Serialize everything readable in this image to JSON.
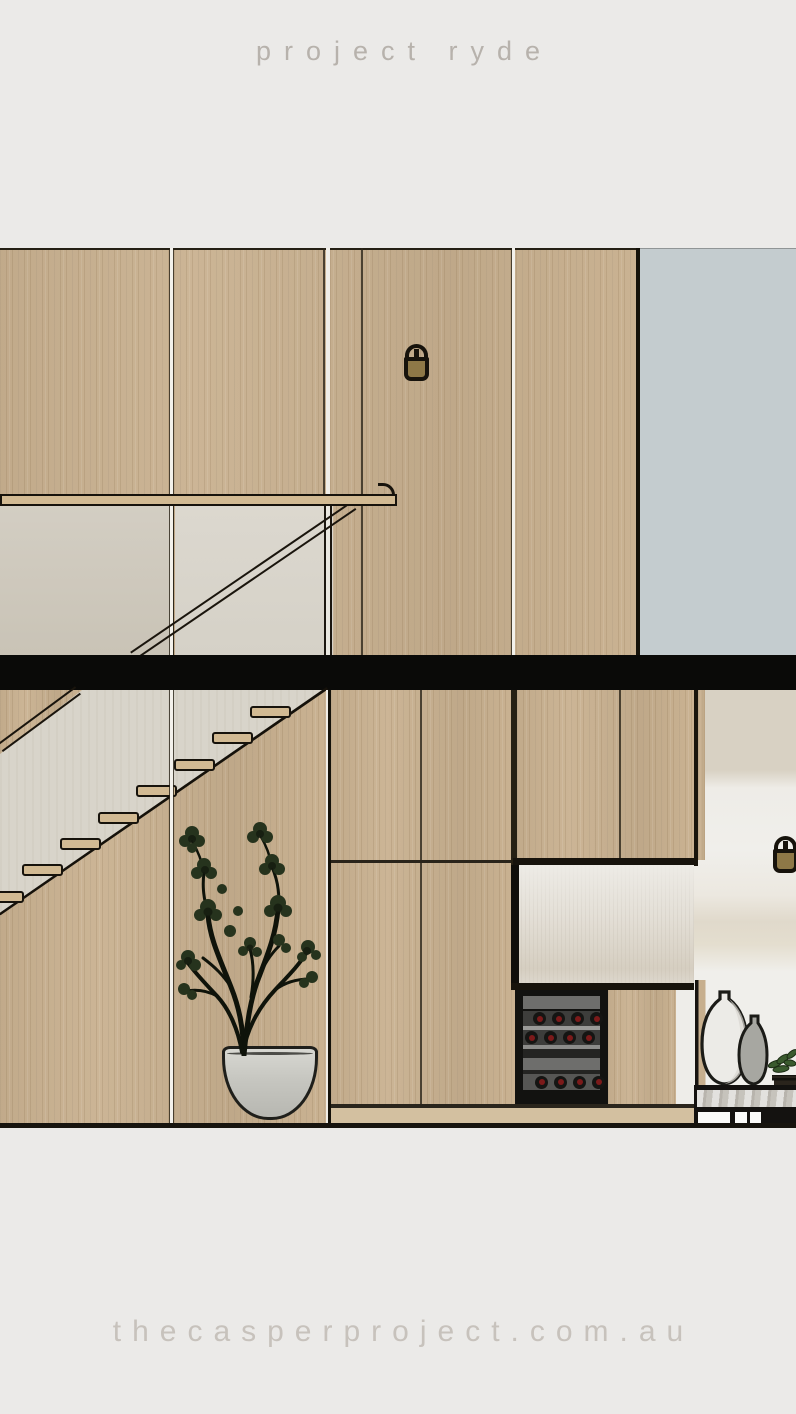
{
  "header": {
    "title": "project ryde"
  },
  "footer": {
    "website": "thecasperproject.com.au"
  },
  "palette": {
    "page-bg": "#ebeae8",
    "header-text": "#b7b2ac",
    "footer-text": "#c7c2bc",
    "timber": "#c9b190",
    "timber-light": "#d2ba93",
    "outline": "#17130c",
    "slab": "#0a0a08",
    "blue-wall": "#c4cccf",
    "plaster": "#d8d4ca",
    "white-wall": "#f0efeb",
    "marble": "#c6c3bc",
    "fridge-frame": "#121210",
    "bottle-red": "#7c1a1a",
    "pot": "#c9c9c3",
    "floor-strip": "#d3c0a0",
    "sconce-body": "#8e7847"
  },
  "scene": {
    "type": "interior sectional elevation render, two storeys",
    "objects": [
      "timber veneer wall panelling",
      "glass stair balustrade with timber handrail",
      "raking stair handrail",
      "concrete floor slab shown in section",
      "floating timber stair treads",
      "stair stringer with timber understair panelling",
      "wall sconce light on upper level",
      "wall sconce light on lower level",
      "potted indoor tree in grey pot",
      "duck-egg blue feature wall",
      "kitchen joinery in timber veneer",
      "integrated wine fridge with bottle shelves",
      "splashback niche",
      "ribbed white feature wall",
      "stone island bench with drawers",
      "two decorative vases",
      "stacked books with trailing plant"
    ],
    "stair": {
      "visible_treads": 8
    },
    "wine_fridge": {
      "rows": 3,
      "bottles_per_row": 4
    }
  }
}
